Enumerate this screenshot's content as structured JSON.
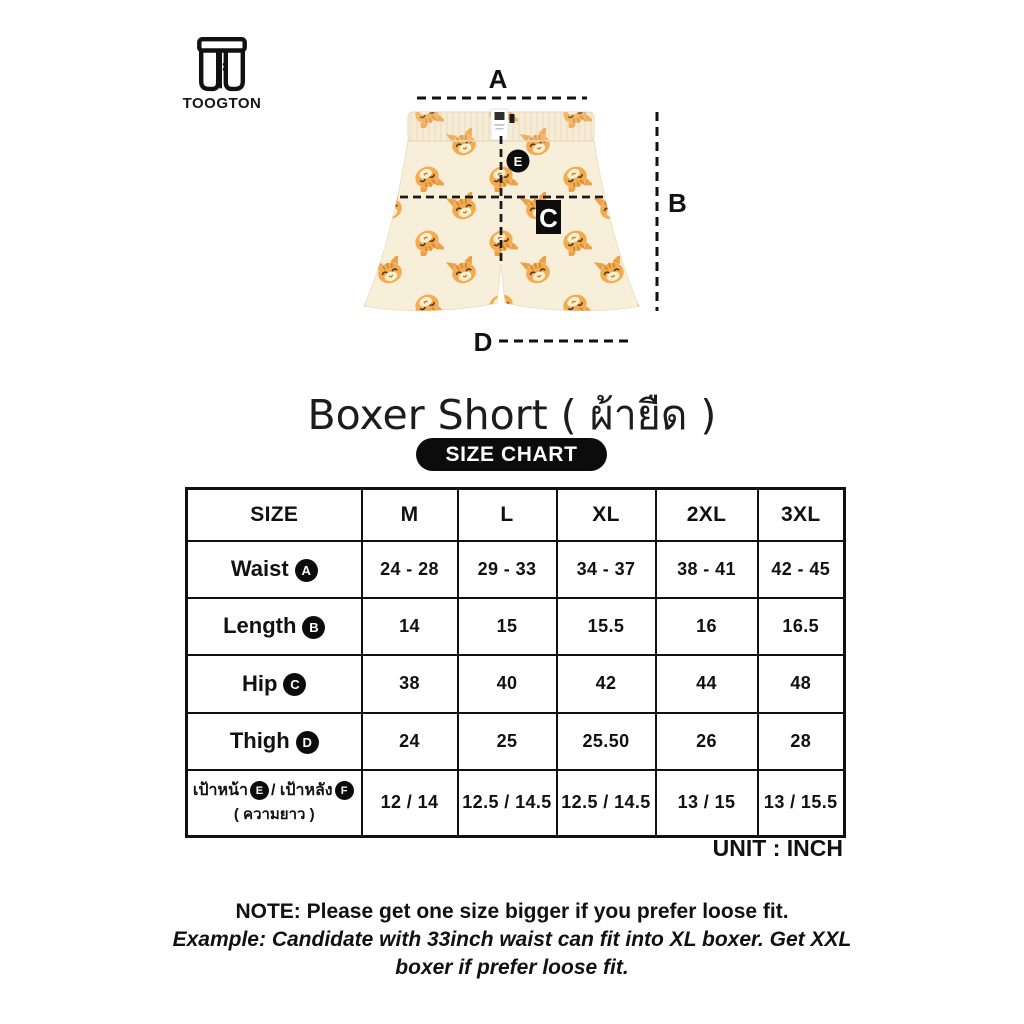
{
  "brand": {
    "name": "TOOGTON"
  },
  "title": "Boxer Short ( ผ้ายืด )",
  "size_chart_badge": "SIZE CHART",
  "diagram": {
    "labels": {
      "a": "A",
      "b": "B",
      "c": "C",
      "d": "D",
      "e": "E"
    }
  },
  "table": {
    "header": [
      "SIZE",
      "M",
      "L",
      "XL",
      "2XL",
      "3XL"
    ],
    "rows": [
      {
        "label": "Waist",
        "badge": "A",
        "values": [
          "24 - 28",
          "29 - 33",
          "34 - 37",
          "38 - 41",
          "42 - 45"
        ]
      },
      {
        "label": "Length",
        "badge": "B",
        "values": [
          "14",
          "15",
          "15.5",
          "16",
          "16.5"
        ]
      },
      {
        "label": "Hip",
        "badge": "C",
        "values": [
          "38",
          "40",
          "42",
          "44",
          "48"
        ]
      },
      {
        "label": "Thigh",
        "badge": "D",
        "values": [
          "24",
          "25",
          "25.50",
          "26",
          "28"
        ]
      },
      {
        "label_front": "เป้าหน้า",
        "badge_front": "E",
        "label_mid": "/ เป้าหลัง",
        "badge_back": "F",
        "label_line2": "( ความยาว )",
        "values": [
          "12 / 14",
          "12.5 / 14.5",
          "12.5 / 14.5",
          "13 / 15",
          "13 / 15.5"
        ]
      }
    ]
  },
  "unit": "UNIT : INCH",
  "note": {
    "line1": "NOTE: Please get one size bigger if you prefer loose fit.",
    "example_line1": "Example: Candidate with 33inch waist can fit into XL boxer. Get XXL",
    "example_line2": "boxer if prefer loose fit."
  },
  "colors": {
    "ink": "#111111",
    "badge_black": "#0c0c0c",
    "fabric_cream": "#f8efdb",
    "cat_orange": "#f3ab4d"
  }
}
